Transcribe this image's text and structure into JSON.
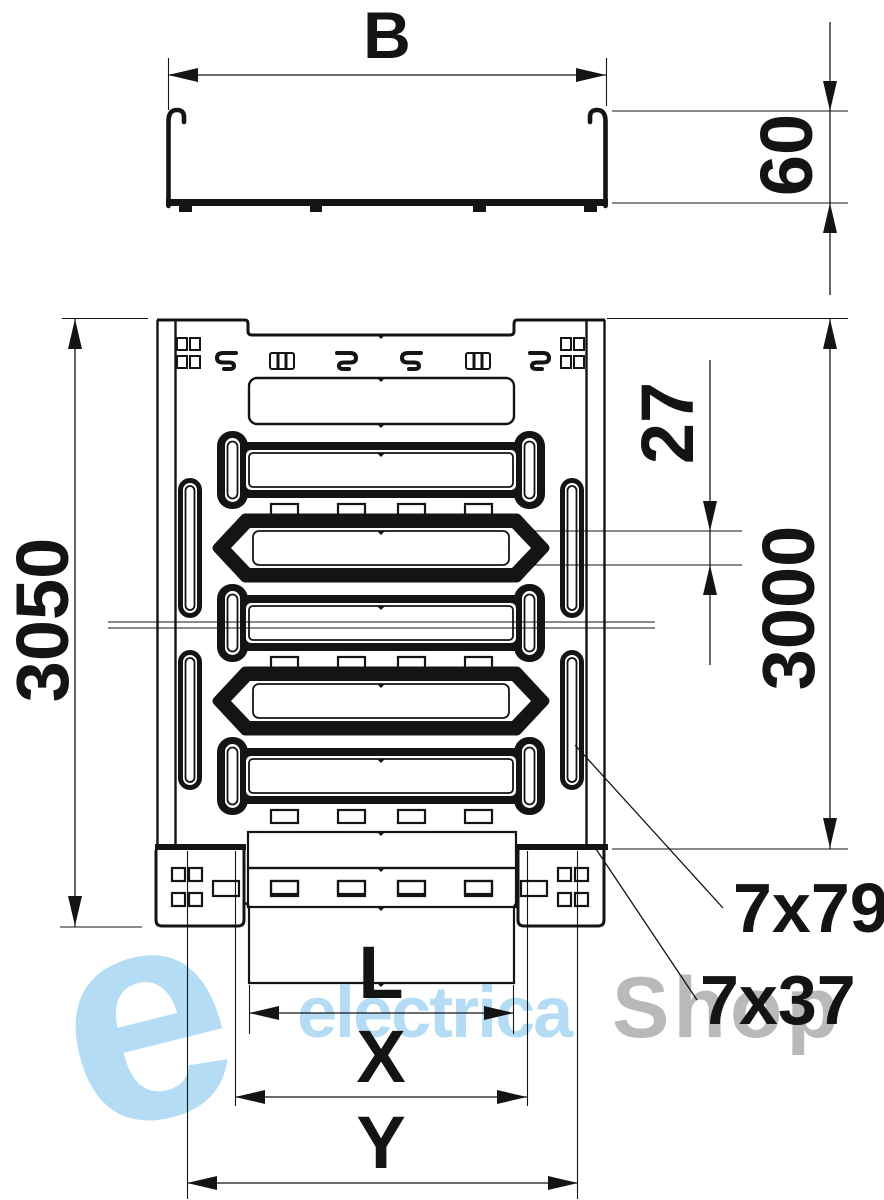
{
  "drawing": {
    "views": {
      "cross_section": {
        "width_dim": "B",
        "height_dim": "60"
      },
      "plan": {
        "overall_length_dim": "3050",
        "body_length_dim": "3000",
        "slot_pitch_dim": "27",
        "side_slot_spec": "7x79",
        "bottom_slot_spec": "7x37",
        "tongue_width_dim": "L",
        "connector_inner_dim": "X",
        "connector_outer_dim": "Y"
      }
    },
    "watermark": {
      "logo": "e",
      "brand_primary": "electrica",
      "brand_secondary": "Shop"
    },
    "colors": {
      "line": "#141414",
      "watermark_blue": "#b4dcf4",
      "watermark_gray": "#b9b9b9",
      "background": "#ffffff"
    }
  }
}
